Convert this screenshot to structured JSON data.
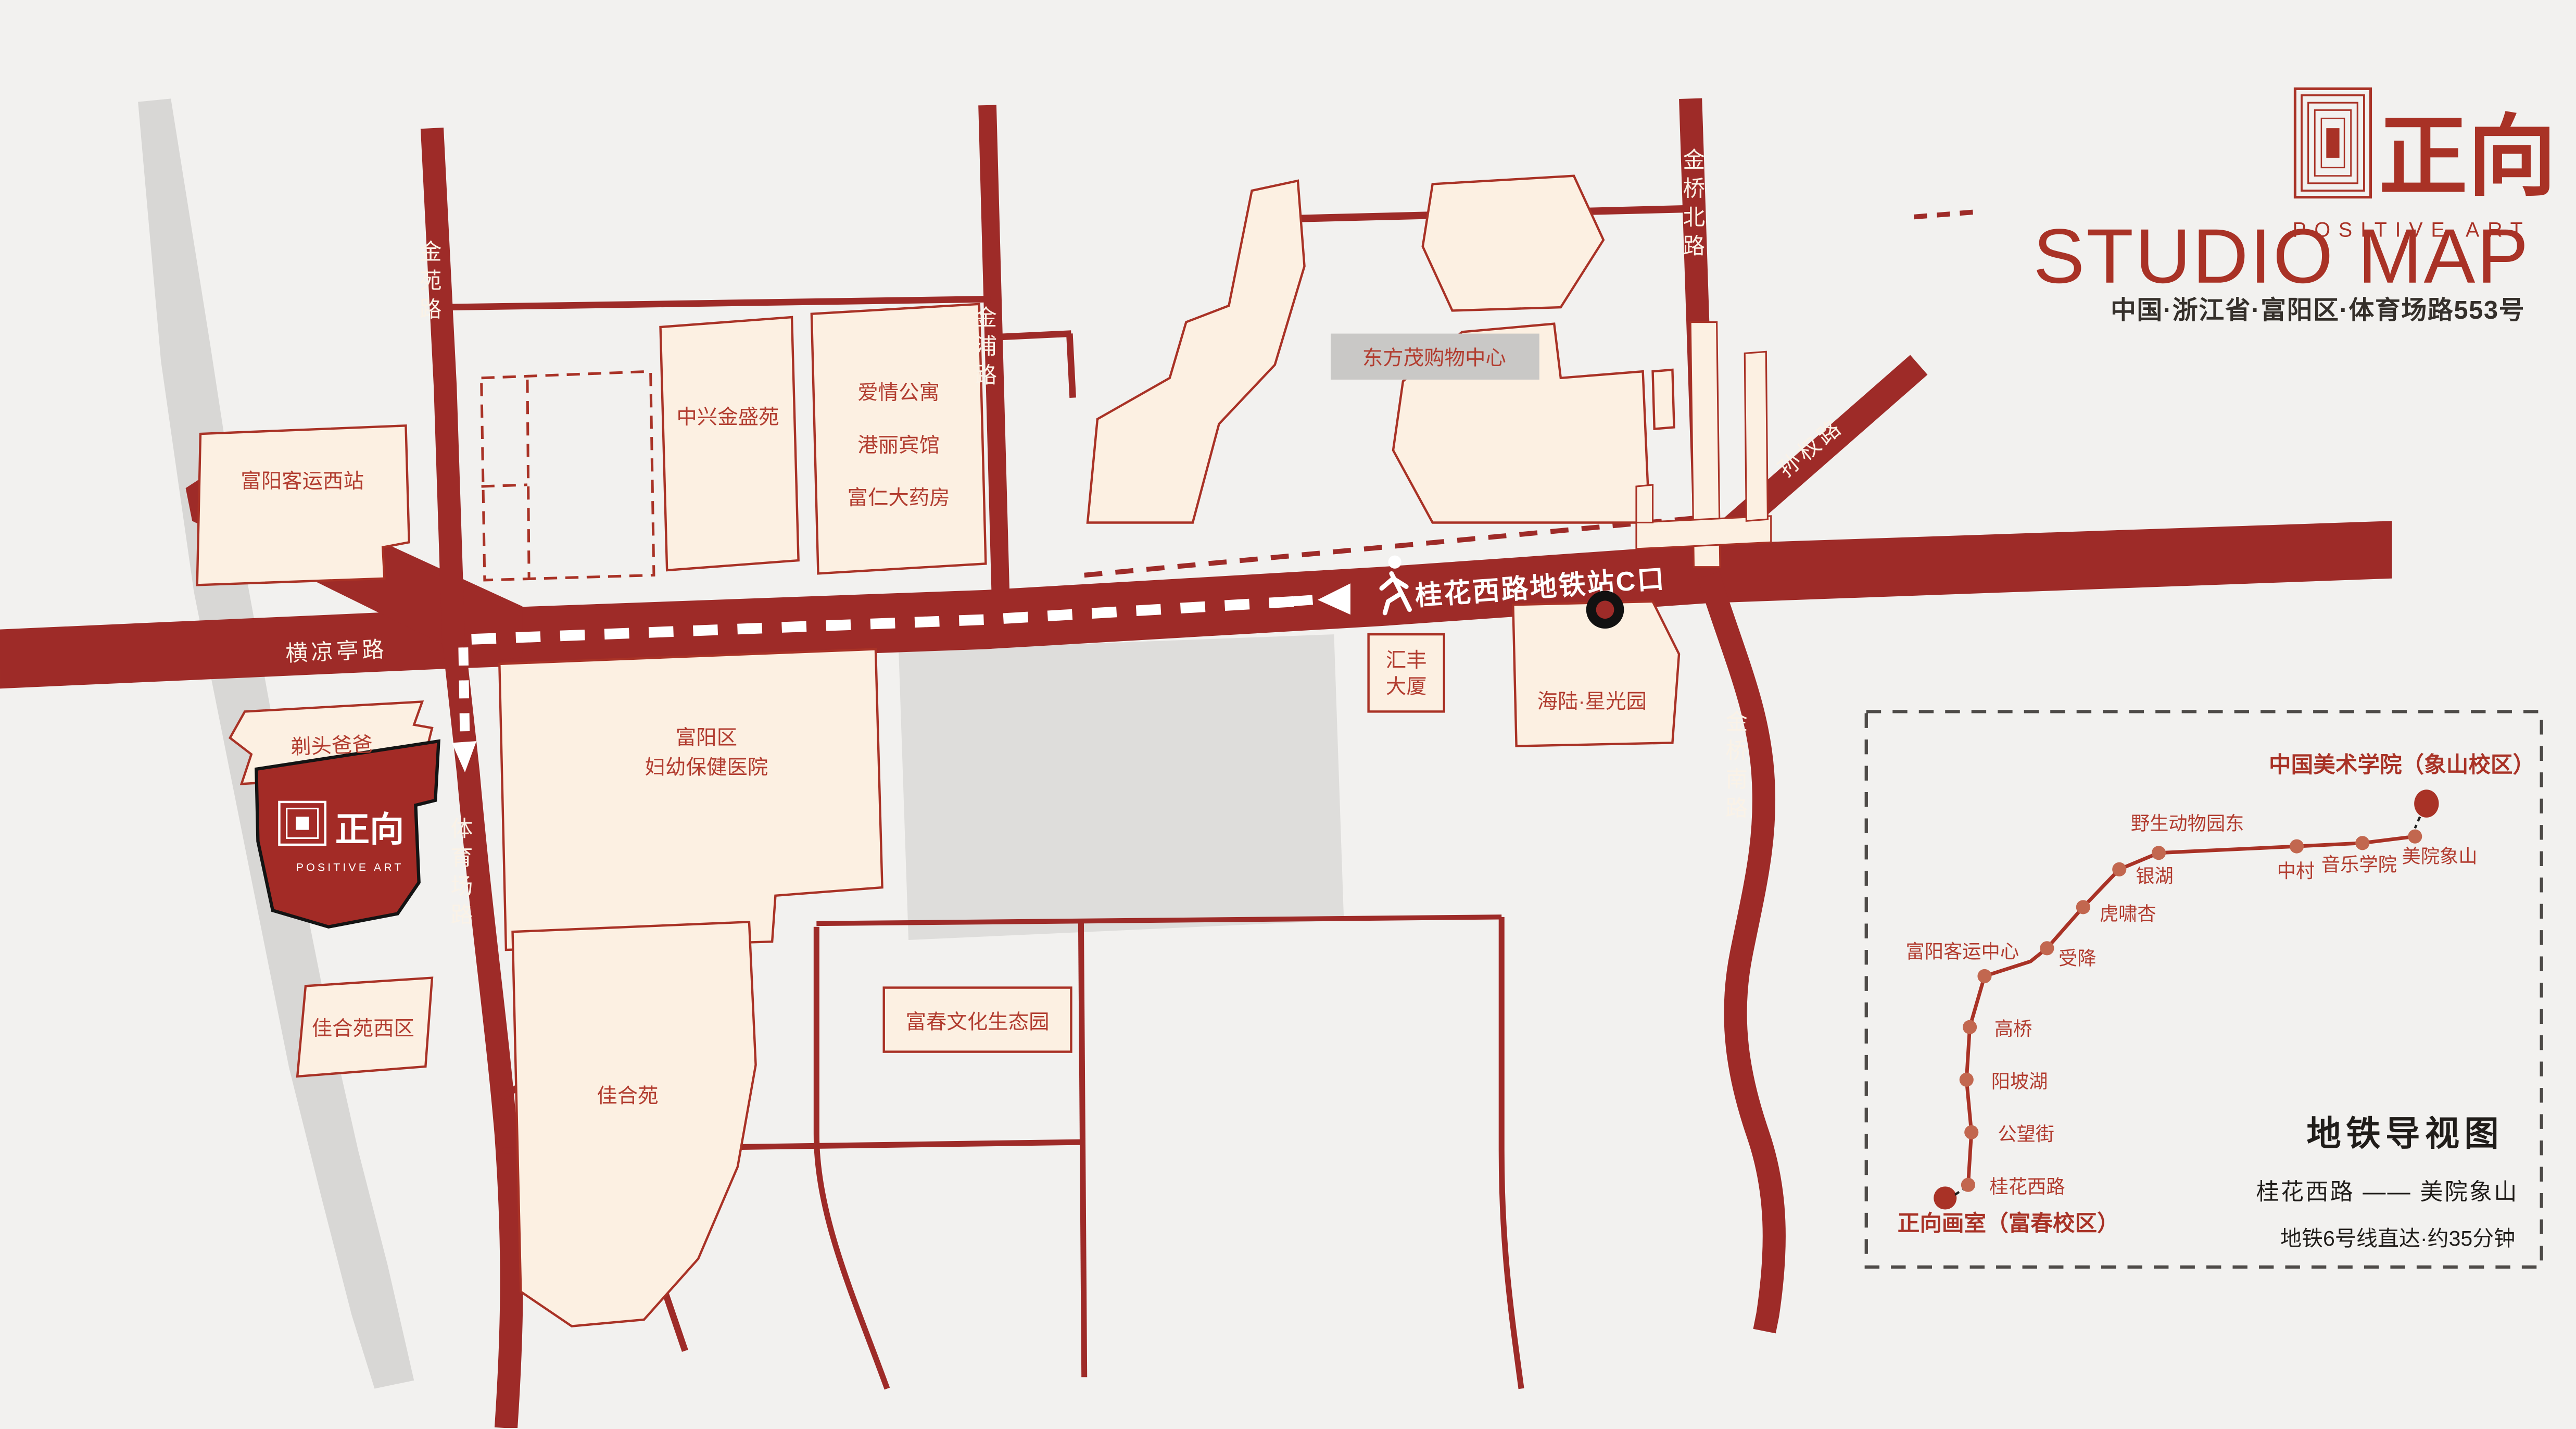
{
  "header": {
    "brand_cn": "正向",
    "brand_en": "POSITIVE ART",
    "title": "STUDIO MAP",
    "address": "中国·浙江省·富阳区·体育场路553号"
  },
  "roads": {
    "jinyuan": "金苑路",
    "jinpu": "金浦路",
    "jinqiao_north": "金桥北路",
    "sunquan": "孙权路",
    "hengliangting": "横凉亭路",
    "tiyuchang": "体育场路",
    "jinqiao_south": "金桥南路"
  },
  "route": {
    "metro_exit": "桂花西路地铁站C口"
  },
  "buildings": {
    "west_station": "富阳客运西站",
    "zhongxing": "中兴金盛苑",
    "apartment": "爱情公寓",
    "hotel": "港丽宾馆",
    "pharmacy": "富仁大药房",
    "mall": "东方茂购物中心",
    "huifeng_line1": "汇丰",
    "huifeng_line2": "大厦",
    "hailu": "海陆·星光园",
    "hospital_line1": "富阳区",
    "hospital_line2": "妇幼保健医院",
    "barber": "剃头爸爸",
    "jiaheyuan_west": "佳合苑西区",
    "jiaheyuan": "佳合苑",
    "eco_park": "富春文化生态园"
  },
  "studio": {
    "name_cn": "正向",
    "name_en": "POSITIVE ART"
  },
  "metro": {
    "panel_title": "地铁导视图",
    "line_summary": "桂花西路 —— 美院象山",
    "note": "地铁6号线直达·约35分钟",
    "start_terminal": "正向画室（富春校区）",
    "end_terminal": "中国美术学院（象山校区）",
    "stations": [
      "桂花西路",
      "公望街",
      "阳坡湖",
      "高桥",
      "富阳客运中心",
      "受降",
      "虎啸杏",
      "银湖",
      "野生动物园东",
      "中村",
      "音乐学院",
      "美院象山"
    ]
  },
  "colors": {
    "background": "#F2F1EF",
    "road": "#9E2B28",
    "building_fill": "#FCF0E2",
    "building_stroke": "#A93226",
    "river_gray": "#D8D7D5",
    "plaza_gray": "#DEDDDB",
    "label_box_gray": "#C9C8C6",
    "text_dark": "#262220"
  }
}
